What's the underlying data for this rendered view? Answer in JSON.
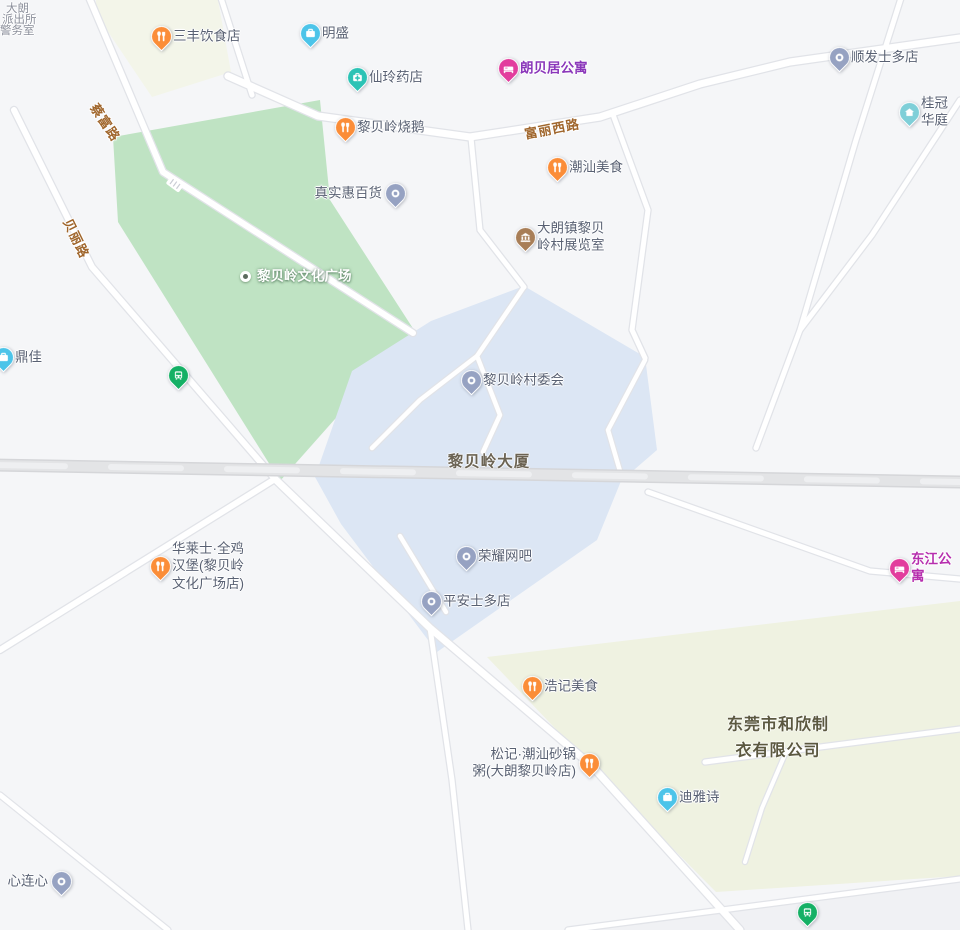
{
  "map_title": "黎贝岭 area map",
  "colors": {
    "bg": "#f5f6f8",
    "park": "#bfe3c3",
    "district": "#dce6f4",
    "industrial": "#eff2e1",
    "block": "#f3f5e9",
    "poi-label": "#596173",
    "road-label": "#a0662c",
    "food-pin": "#fb8d38",
    "business-pin": "#4cc4e9",
    "pharmacy-pin": "#2cc3b5",
    "apartment-pin": "#e23d9d",
    "museum-pin": "#a87e57",
    "generic-pin": "#96a2c2",
    "bus-pin": "#15b065",
    "house-pin": "#7fcfd8"
  },
  "poi_pins": [
    {
      "label": "三丰饮食店",
      "icon": "food",
      "color": "#fb8d38",
      "x": 161,
      "y": 36,
      "side": "right"
    },
    {
      "label": "明盛",
      "icon": "briefcase",
      "color": "#4cc4e9",
      "x": 310,
      "y": 33,
      "side": "right"
    },
    {
      "label": "仙玲药店",
      "icon": "medical",
      "color": "#2cc3b5",
      "x": 357,
      "y": 77,
      "side": "right"
    },
    {
      "label": "朗贝居公寓",
      "icon": "bed",
      "color": "#e23d9d",
      "x": 508,
      "y": 68,
      "side": "right",
      "label_color": "#8a36ba",
      "bold": true
    },
    {
      "label": "顺发士多店",
      "icon": "dot",
      "color": "#96a2c2",
      "x": 839,
      "y": 57,
      "side": "right"
    },
    {
      "label": "桂冠华庭",
      "icon": "house",
      "color": "#7fcfd8",
      "x": 909,
      "y": 112,
      "side": "right"
    },
    {
      "label": "黎贝岭烧鹅",
      "icon": "food",
      "color": "#fb8d38",
      "x": 345,
      "y": 127,
      "side": "right"
    },
    {
      "label": "潮汕美食",
      "icon": "food",
      "color": "#fb8d38",
      "x": 557,
      "y": 167,
      "side": "right"
    },
    {
      "label": "真实惠百货",
      "icon": "dot",
      "color": "#96a2c2",
      "x": 395,
      "y": 193,
      "side": "left"
    },
    {
      "label": "大朗镇黎贝\n岭村展览室",
      "icon": "museum",
      "color": "#a87e57",
      "x": 525,
      "y": 237,
      "side": "right"
    },
    {
      "label": "黎贝岭文化广场",
      "icon": "plaza",
      "color": "#ffffff",
      "x": 245,
      "y": 276,
      "side": "right",
      "white": true
    },
    {
      "label": "鼎佳",
      "icon": "briefcase",
      "color": "#4cc4e9",
      "x": 3,
      "y": 357,
      "side": "right"
    },
    {
      "label": "黎贝岭村委会",
      "icon": "dot",
      "color": "#96a2c2",
      "x": 471,
      "y": 380,
      "side": "right"
    },
    {
      "label": "华莱士·全鸡\n汉堡(黎贝岭\n文化广场店)",
      "icon": "food",
      "color": "#fb8d38",
      "x": 160,
      "y": 566,
      "side": "right"
    },
    {
      "label": "荣耀网吧",
      "icon": "dot",
      "color": "#96a2c2",
      "x": 466,
      "y": 556,
      "side": "right"
    },
    {
      "label": "东江公寓",
      "icon": "bed",
      "color": "#e23d9d",
      "x": 899,
      "y": 568,
      "side": "right",
      "label_color": "#b62fae",
      "bold": true
    },
    {
      "label": "平安士多店",
      "icon": "dot",
      "color": "#96a2c2",
      "x": 431,
      "y": 601,
      "side": "right"
    },
    {
      "label": "浩记美食",
      "icon": "food",
      "color": "#fb8d38",
      "x": 532,
      "y": 686,
      "side": "right"
    },
    {
      "label": "松记·潮汕砂锅\n粥(大朗黎贝岭店)",
      "icon": "food",
      "color": "#fb8d38",
      "x": 589,
      "y": 763,
      "side": "left"
    },
    {
      "label": "迪雅诗",
      "icon": "briefcase",
      "color": "#4cc4e9",
      "x": 667,
      "y": 797,
      "side": "right"
    },
    {
      "label": "心连心",
      "icon": "dot",
      "color": "#96a2c2",
      "x": 61,
      "y": 881,
      "side": "left"
    },
    {
      "label": "",
      "icon": "bus",
      "color": "#15b065",
      "x": 178,
      "y": 375,
      "side": "right"
    },
    {
      "label": "",
      "icon": "bus",
      "color": "#15b065",
      "x": 807,
      "y": 912,
      "side": "right"
    }
  ],
  "road_labels": [
    {
      "text": "蔡富路",
      "x": 106,
      "y": 122,
      "angle": 56
    },
    {
      "text": "贝丽路",
      "x": 77,
      "y": 238,
      "angle": 64
    },
    {
      "text": "富丽西路",
      "x": 552,
      "y": 128,
      "angle": -11
    }
  ],
  "area_labels": [
    {
      "text": "黎贝岭大厦",
      "x": 489,
      "y": 463,
      "color": "#6b6353",
      "size": 15.5
    },
    {
      "text": "东莞市和欣制\n衣有限公司",
      "x": 778,
      "y": 738,
      "color": "#5b5840",
      "size": 16
    }
  ],
  "corner_building": {
    "lines": [
      "大朗",
      "派出所",
      "警务室"
    ]
  }
}
